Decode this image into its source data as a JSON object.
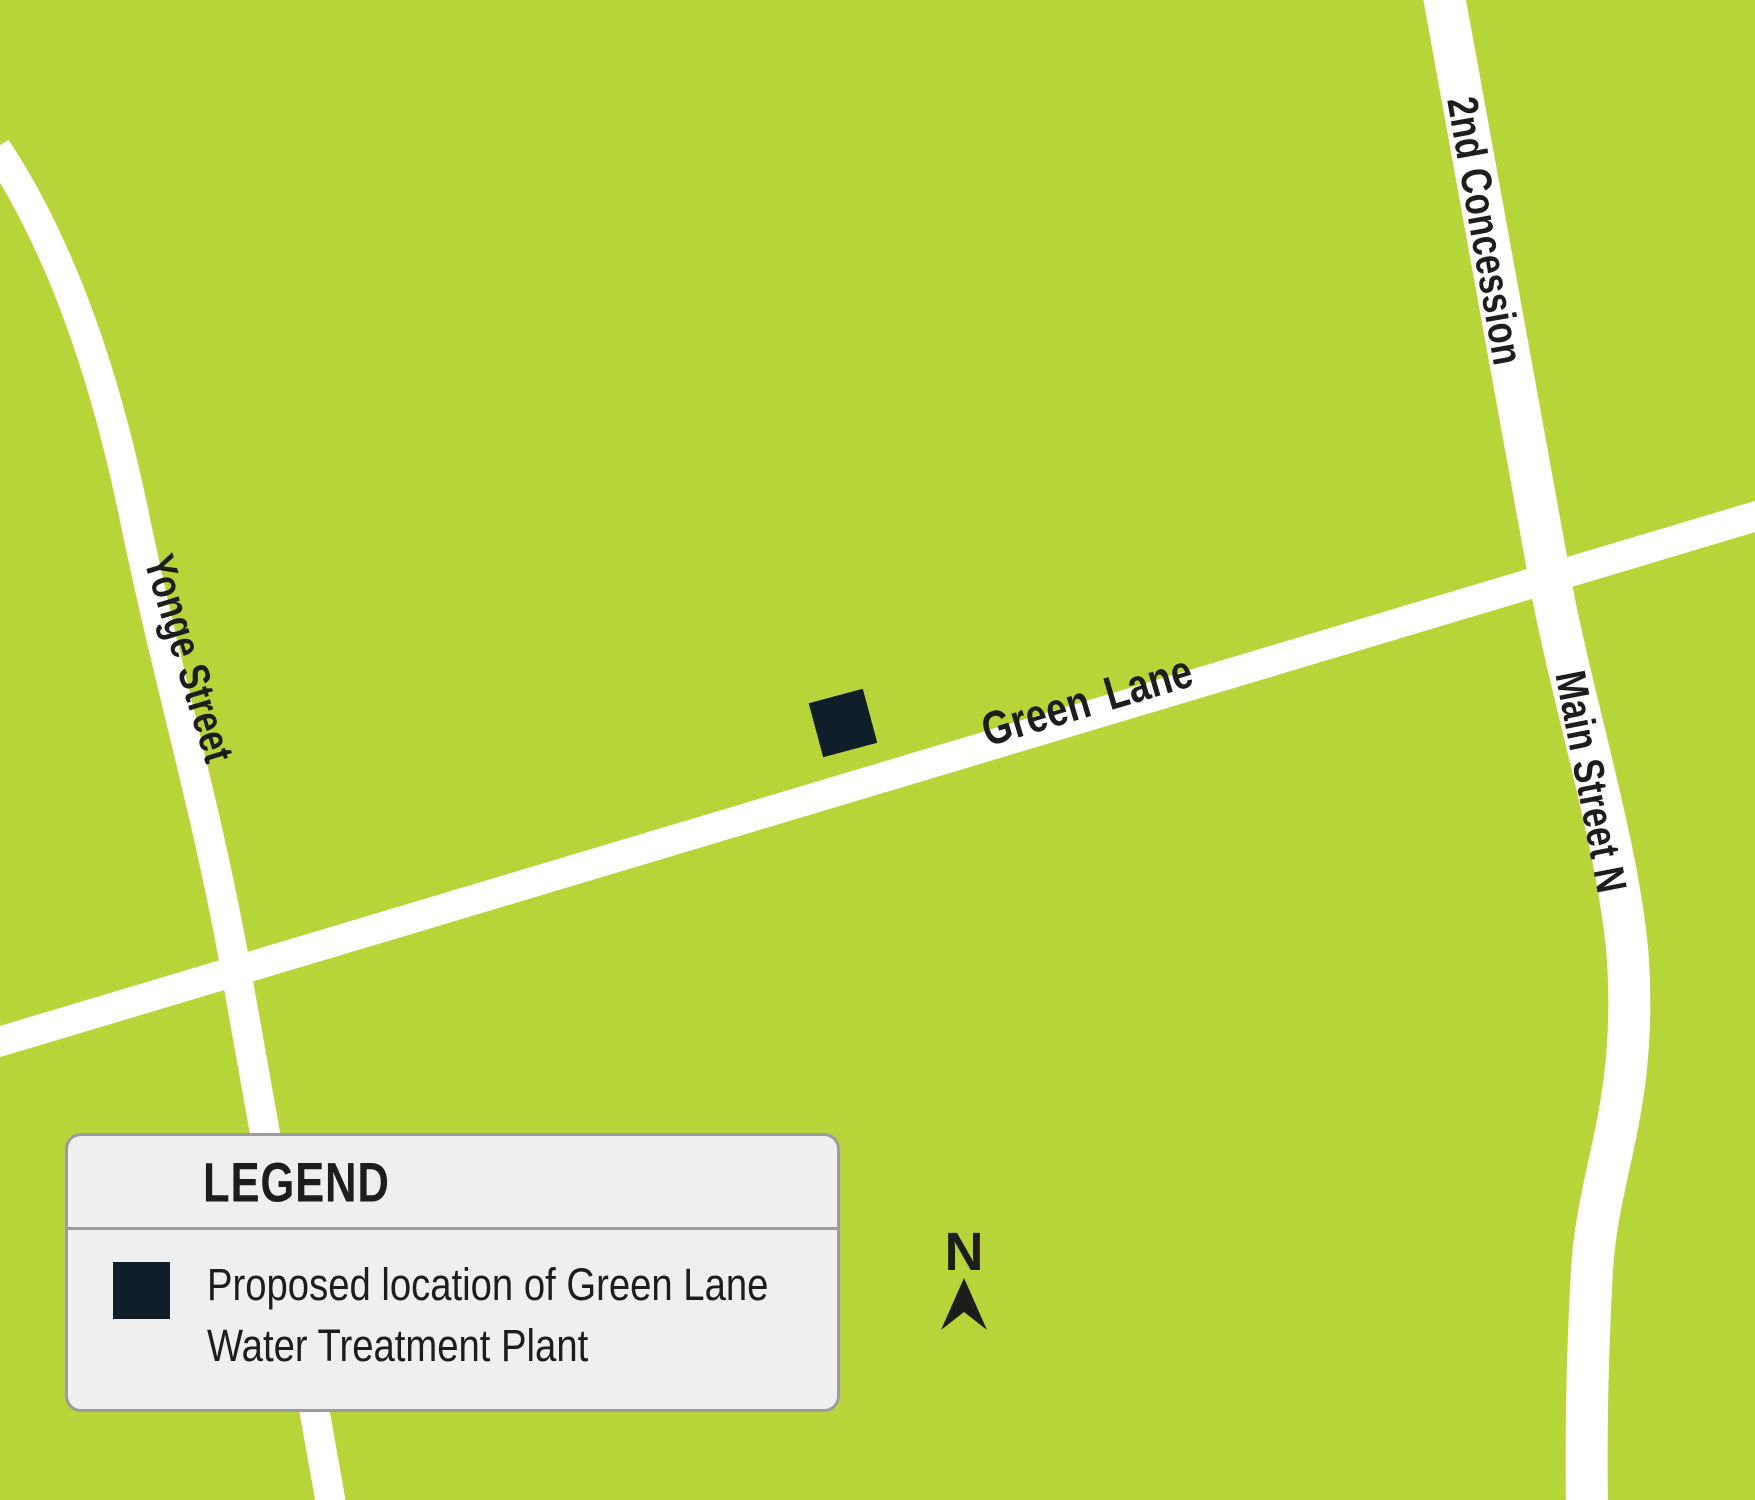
{
  "map": {
    "background_color": "#b7d438",
    "road_color": "#ffffff",
    "label_color": "#1d1d1b",
    "streets": {
      "yonge": "Yonge Street",
      "green_lane": "Green Lane",
      "second_concession": "2nd Concession",
      "main_street_n": "Main Street N"
    },
    "marker": {
      "color": "#101e29",
      "meaning": "Proposed location of Green Lane Water Treatment Plant"
    }
  },
  "legend": {
    "title": "LEGEND",
    "items": [
      {
        "swatch_color": "#101e29",
        "label_lines": [
          "Proposed location of Green Lane",
          "Water Treatment Plant"
        ]
      }
    ]
  },
  "compass": {
    "north_label": "N"
  }
}
